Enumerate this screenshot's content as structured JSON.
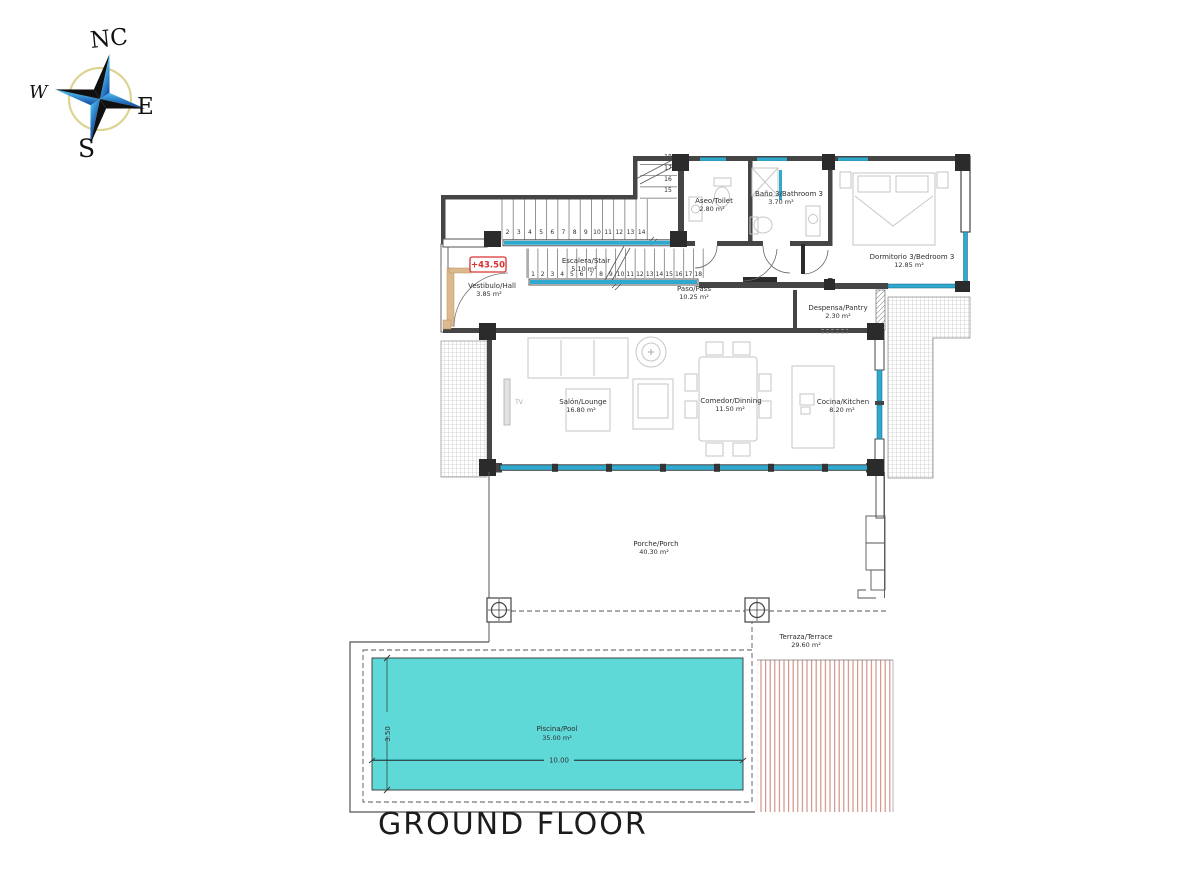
{
  "annotations": {
    "title": "GROUND FLOOR",
    "level": "+43.50",
    "tv": "TV",
    "pool_width": "10.00",
    "pool_depth": "3.50"
  },
  "compass": {
    "n": "NC",
    "e": "E",
    "s": "S",
    "w": "W"
  },
  "rooms": {
    "hall": {
      "name": "Vestibulo/Hall",
      "area": "3.85 m²"
    },
    "stair": {
      "name": "Escalera/Stair",
      "area": "5.10 m²"
    },
    "pass": {
      "name": "Paso/Pass",
      "area": "10.25 m²"
    },
    "toilet": {
      "name": "Aseo/Toilet",
      "area": "2.80 m²"
    },
    "bathroom3": {
      "name": "Baño 3/Bathroom 3",
      "area": "3.70 m²"
    },
    "bedroom3": {
      "name": "Dormitorio 3/Bedroom 3",
      "area": "12.85 m²"
    },
    "pantry": {
      "name": "Despensa/Pantry",
      "area": "2.30 m²"
    },
    "lounge": {
      "name": "Salón/Lounge",
      "area": "16.80 m²"
    },
    "dining": {
      "name": "Comedor/Dinning",
      "area": "11.50 m²"
    },
    "kitchen": {
      "name": "Cocina/Kitchen",
      "area": "8.20 m²"
    },
    "porch": {
      "name": "Porche/Porch",
      "area": "40.30 m²"
    },
    "terrace": {
      "name": "Terraza/Terrace",
      "area": "29.60 m²"
    },
    "pool": {
      "name": "Piscina/Pool",
      "area": "35.00 m²"
    }
  },
  "stairs": {
    "upper_run": [
      "2",
      "3",
      "4",
      "5",
      "6",
      "7",
      "8",
      "9",
      "10",
      "11",
      "12",
      "13",
      "14"
    ],
    "upper_turn": [
      "15",
      "16",
      "17",
      "18"
    ],
    "lower_run": [
      "1",
      "2",
      "3",
      "4",
      "5",
      "6",
      "7",
      "8",
      "9",
      "10",
      "11",
      "12",
      "13",
      "14",
      "15",
      "16",
      "17",
      "18"
    ]
  },
  "colors": {
    "pool_fill": "#5fd8d8",
    "window_glass": "#2fa9cd",
    "deck_stripe": "#cf8b80",
    "level_marker": "#d93030",
    "wall": "#454545",
    "compass_ring": "#dcd492"
  }
}
